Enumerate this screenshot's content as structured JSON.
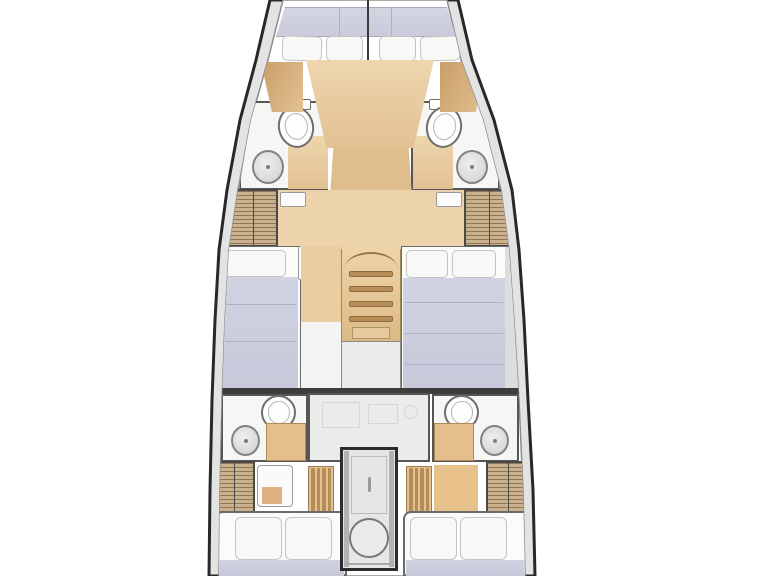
{
  "diagram": {
    "type": "boat-interior-floor-plan",
    "subject": "sailing yacht deck layout, top-down view, bow at top, stern cut off at bottom",
    "symmetry": "near-mirror about fore-aft centerline",
    "areas": [
      {
        "name": "forward-v-berth",
        "features": [
          "padded mattress band",
          "four pillows",
          "wood headboard panels"
        ]
      },
      {
        "name": "forward-head-port",
        "fixtures": [
          "toilet with cistern",
          "round sink",
          "wood sole section"
        ]
      },
      {
        "name": "forward-head-starboard",
        "fixtures": [
          "toilet with cistern",
          "round sink",
          "wood sole section"
        ]
      },
      {
        "name": "central-wood-console",
        "features": [
          "tapering table/console",
          "walkway with rounded end"
        ]
      },
      {
        "name": "wardrobe-forward-port",
        "features": [
          "louvered double doors"
        ]
      },
      {
        "name": "wardrobe-forward-starboard",
        "features": [
          "louvered double doors"
        ]
      },
      {
        "name": "mid-cabin-port",
        "features": [
          "berth with one pillow",
          "lavender mattress",
          "wood floor strip"
        ]
      },
      {
        "name": "companionway-stairs",
        "features": [
          "arched top",
          "four treads",
          "lower landing"
        ]
      },
      {
        "name": "mid-cabin-starboard",
        "features": [
          "double berth with two pillows",
          "lavender mattress"
        ]
      },
      {
        "name": "aft-head-port",
        "fixtures": [
          "toilet",
          "round sink",
          "wood counter"
        ]
      },
      {
        "name": "center-galley-unit",
        "features": [
          "light gray cabinet block with faint fittings"
        ]
      },
      {
        "name": "aft-head-starboard",
        "fixtures": [
          "toilet",
          "round sink",
          "wood counter"
        ]
      },
      {
        "name": "wardrobe-aft-port",
        "features": [
          "louvered doors"
        ]
      },
      {
        "name": "wardrobe-aft-starboard",
        "features": [
          "louvered doors"
        ]
      },
      {
        "name": "companion-steps-aft-port",
        "features": [
          "wood slat steps"
        ]
      },
      {
        "name": "companion-steps-aft-starboard",
        "features": [
          "wood slat steps"
        ]
      },
      {
        "name": "engine-compartment",
        "features": [
          "outlined box",
          "round hatch",
          "tiny illegible vertical label"
        ]
      },
      {
        "name": "aft-cabin-port",
        "features": [
          "double berth, two square pillows",
          "mattress cut by image edge"
        ]
      },
      {
        "name": "aft-cabin-starboard",
        "features": [
          "double berth, two square pillows",
          "mattress cut by image edge"
        ]
      }
    ],
    "fixture_counts": {
      "toilets": 4,
      "sinks": 4,
      "wardrobes": 4,
      "berths": 5,
      "stair_treads": 4
    }
  },
  "colors": {
    "hull": "#282828",
    "deck": "#e3e3e3",
    "wall": "#565656",
    "bath": "#f6f6f4",
    "galley": "#ebebe9",
    "wood": "#e2c193",
    "wood_light": "#eed6ad",
    "wood_dark": "#c99e68",
    "tread": "#b68d57",
    "hatch": "#cbb18d",
    "mattress": "#c7c9da",
    "pillow": "#f8f8f6",
    "fixture": "#d9d9d9"
  }
}
